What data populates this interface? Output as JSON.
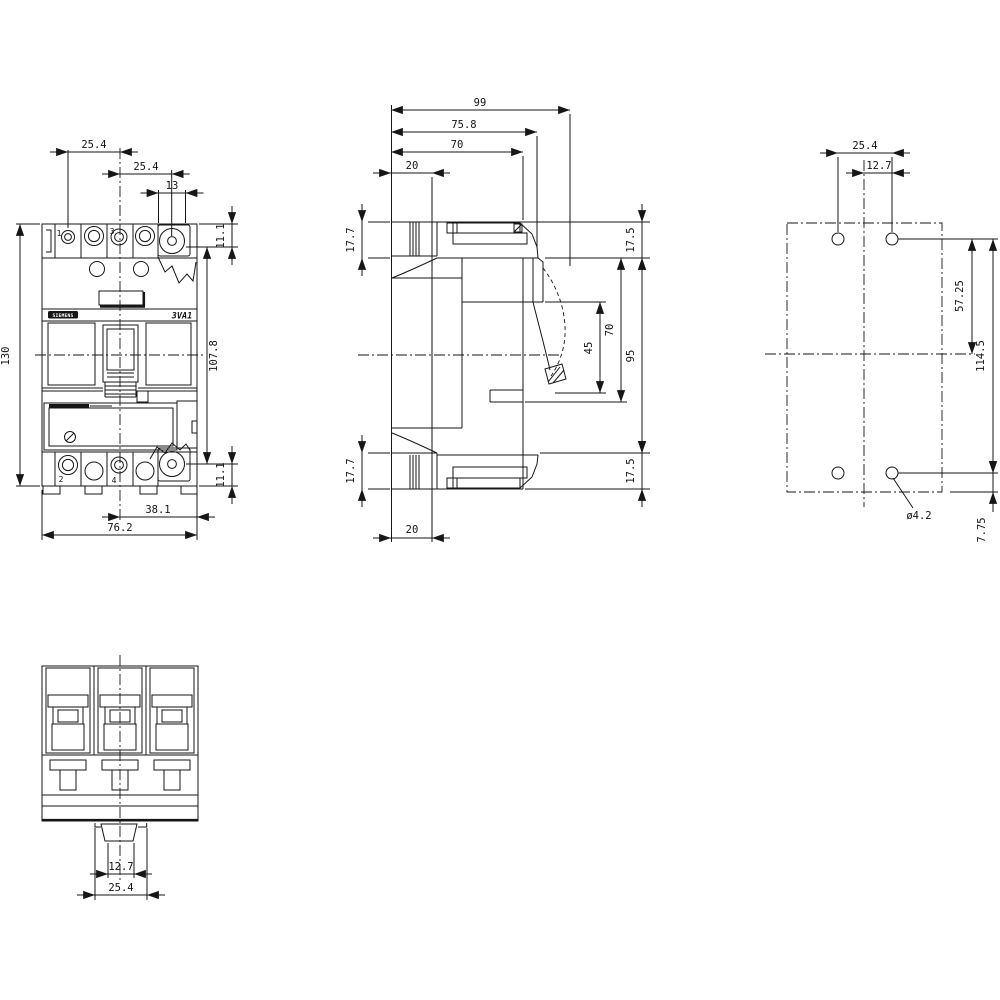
{
  "drawing": {
    "brand": "SIEMENS",
    "model": "3VA1",
    "views": {
      "front": {
        "pole_top_1": "1",
        "pole_top_3": "3",
        "pole_bottom_2": "2",
        "pole_bottom_4": "4",
        "dims": {
          "pole_pitch_left": "25.4",
          "pole_pitch_right": "25.4",
          "terminal_width": "13",
          "terminal_offset_top": "11.1",
          "overall_height": "130",
          "terminal_span": "107.8",
          "terminal_offset_bottom": "11.1",
          "center_to_edge": "38.1",
          "overall_width": "76.2"
        }
      },
      "side": {
        "dims": {
          "depth_overall": "99",
          "depth_with_cover": "75.8",
          "depth_body": "70",
          "rail_recess_top": "20",
          "terminal_height_top": "17.7",
          "edge_to_step_top": "17.5",
          "handle_recess": "45",
          "front_recess": "70",
          "body_span": "95",
          "terminal_height_bottom": "17.7",
          "edge_to_step_bottom": "17.5",
          "rail_recess_bottom": "20"
        }
      },
      "drill": {
        "dims": {
          "hole_pitch": "25.4",
          "hole_to_center": "12.7",
          "hole_to_midline": "57.25",
          "hole_span_vertical": "114.5",
          "hole_diameter": "ø4.2",
          "hole_to_bottom": "7.75"
        }
      },
      "bottom": {
        "dims": {
          "latch_width": "12.7",
          "latch_pitch": "25.4"
        }
      }
    }
  }
}
